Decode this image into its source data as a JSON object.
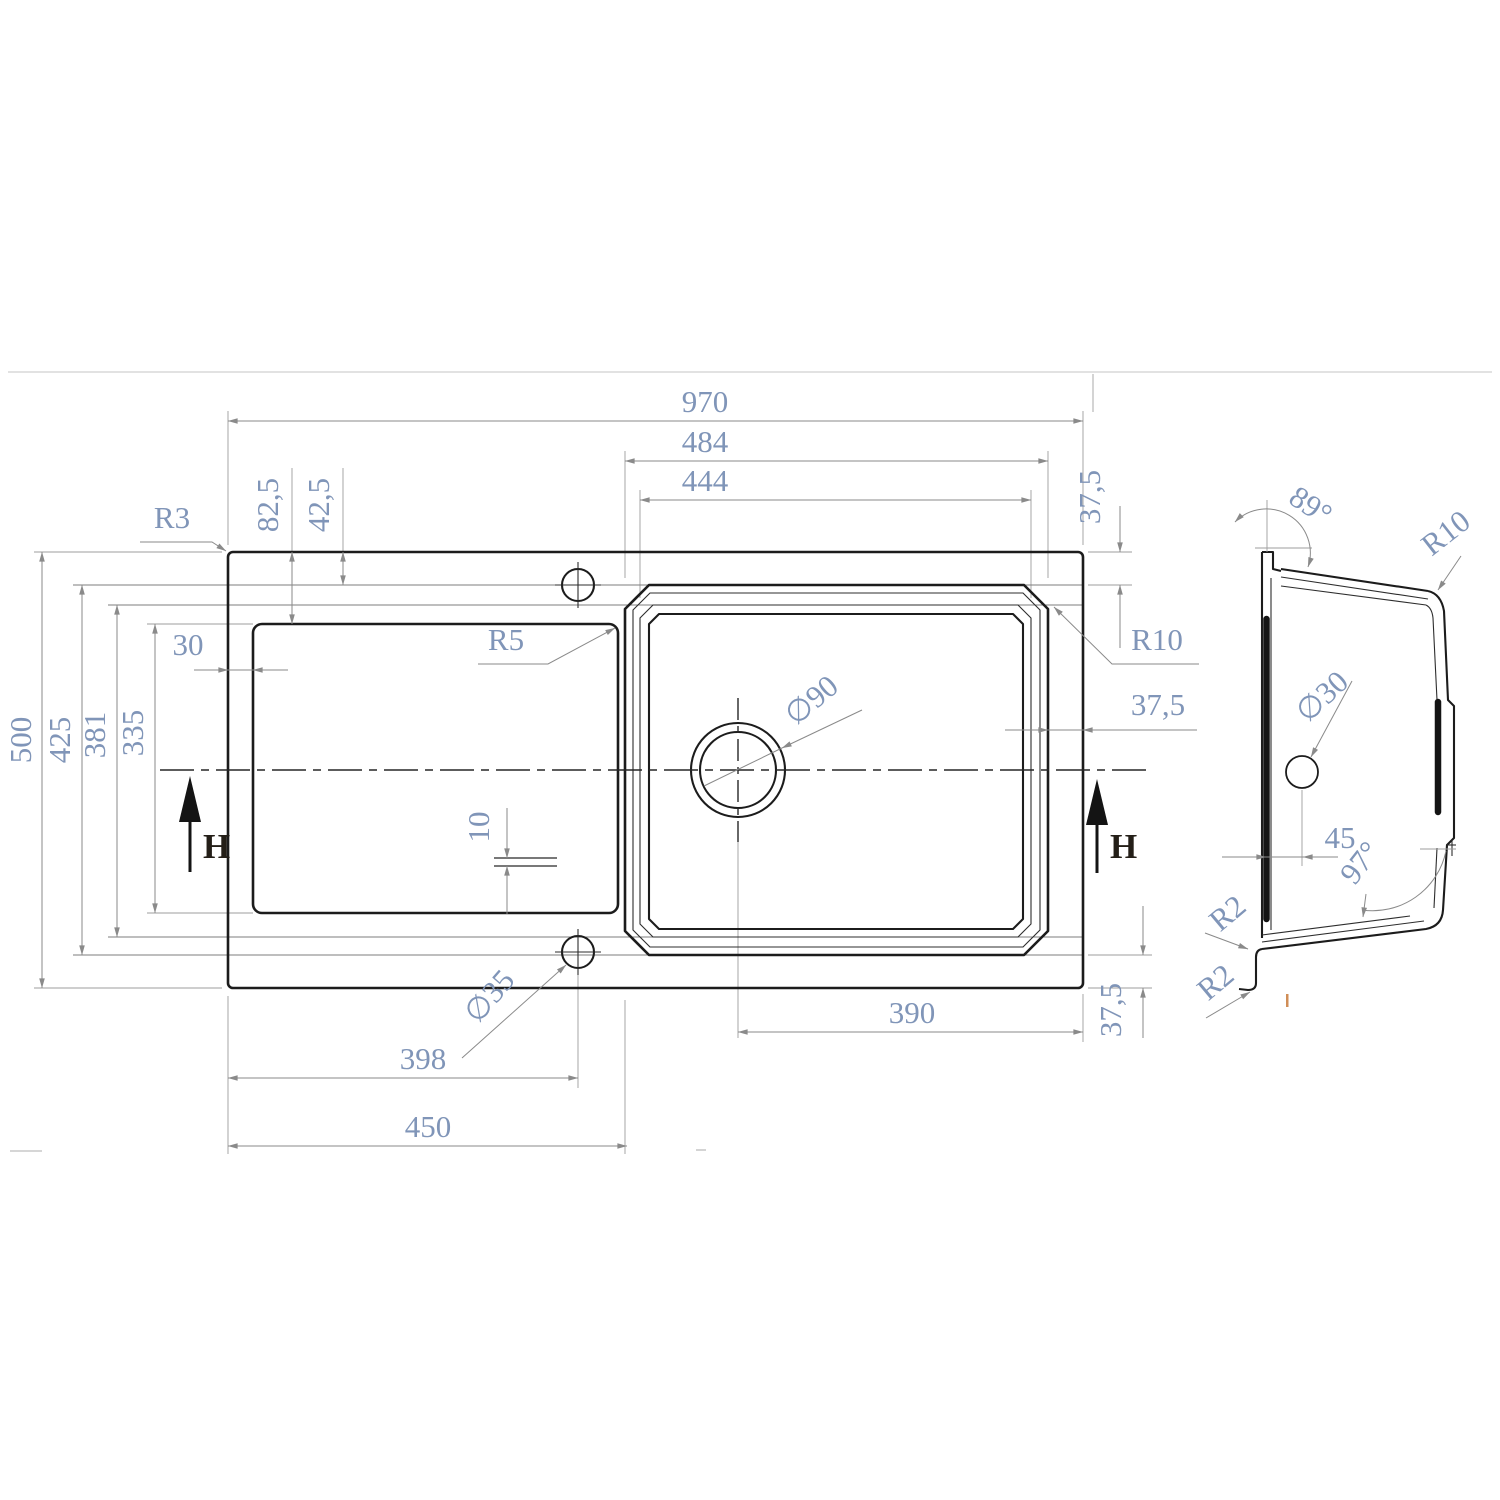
{
  "drawing": {
    "kind": "technical dimension drawing",
    "subject": "kitchen sink with drainboard",
    "units": "mm",
    "colors": {
      "outline": "#1c1c1c",
      "dimension_lines": "#8a8a8a",
      "dimension_text": "#8095b8",
      "background": "#ffffff"
    },
    "views": {
      "top_view": {
        "name": "plan view",
        "dims": {
          "overall_width": "970",
          "bowl_rim_width": "484",
          "bowl_inner_width": "444",
          "overall_depth": "500",
          "bowl_rim_depth": "425",
          "bowl_step_depth": "381",
          "drainboard_depth": "335",
          "drainboard_inset": "30",
          "edge_to_drainboard": "82,5",
          "edge_to_tap_axis": "42,5",
          "rim_width_top": "37,5",
          "rim_width_right": "37,5",
          "rim_width_bottom": "37,5",
          "groove_spacing": "10",
          "tap_hole_offset": "398",
          "drainboard_width": "450",
          "drain_center_to_edge": "390",
          "outer_corner_radius": "R3",
          "drainboard_corner_radius": "R5",
          "bowl_corner_radius": "R10",
          "tap_hole_diameter": "∅35",
          "drain_hole_diameter": "∅90",
          "section_arrow_left": "H",
          "section_arrow_right": "H"
        }
      },
      "section_view": {
        "name": "section view H-H",
        "dims": {
          "rim_wall_angle": "89°",
          "top_corner_radius": "R10",
          "overflow_hole_diameter": "∅30",
          "overflow_offset": "45",
          "bowl_bottom_angle": "97°",
          "bottom_corner_radius": "R2",
          "lip_corner_radius": "R2"
        }
      }
    }
  }
}
